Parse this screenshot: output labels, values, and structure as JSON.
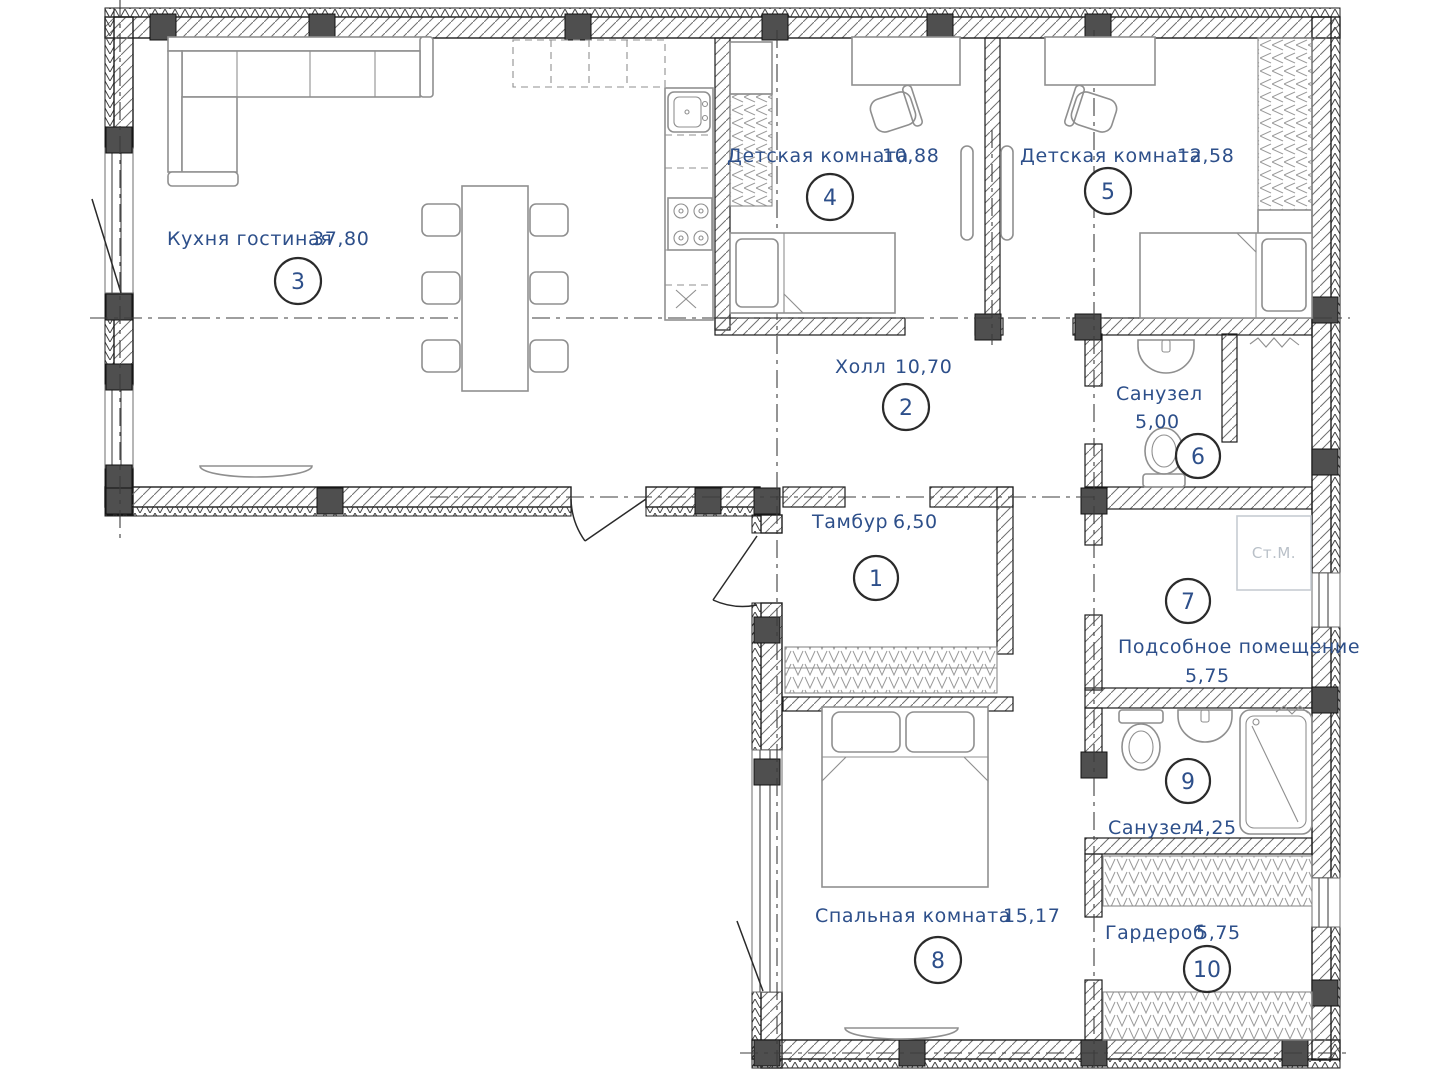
{
  "plan": {
    "type": "floor-plan",
    "colors": {
      "label": "#2d4f8a",
      "wall": "#1c1c1c",
      "furniture": "#8f8f8f",
      "appliance": "#b9c0c8"
    }
  },
  "rooms": [
    {
      "number": "1",
      "name": "Тамбур",
      "area": "6,50"
    },
    {
      "number": "2",
      "name": "Холл",
      "area": "10,70"
    },
    {
      "number": "3",
      "name": "Кухня гостиная",
      "area": "37,80"
    },
    {
      "number": "4",
      "name": "Детская комната",
      "area": "10,88"
    },
    {
      "number": "5",
      "name": "Детская комната",
      "area": "12,58"
    },
    {
      "number": "6",
      "name": "Санузел",
      "area": "5,00"
    },
    {
      "number": "7",
      "name": "Подсобное помещение",
      "area": "5,75"
    },
    {
      "number": "8",
      "name": "Спальная комната",
      "area": "15,17"
    },
    {
      "number": "9",
      "name": "Санузел",
      "area": "4,25"
    },
    {
      "number": "10",
      "name": "Гардероб",
      "area": "5,75"
    }
  ],
  "labels": {
    "washing_machine": "Ст.М."
  }
}
